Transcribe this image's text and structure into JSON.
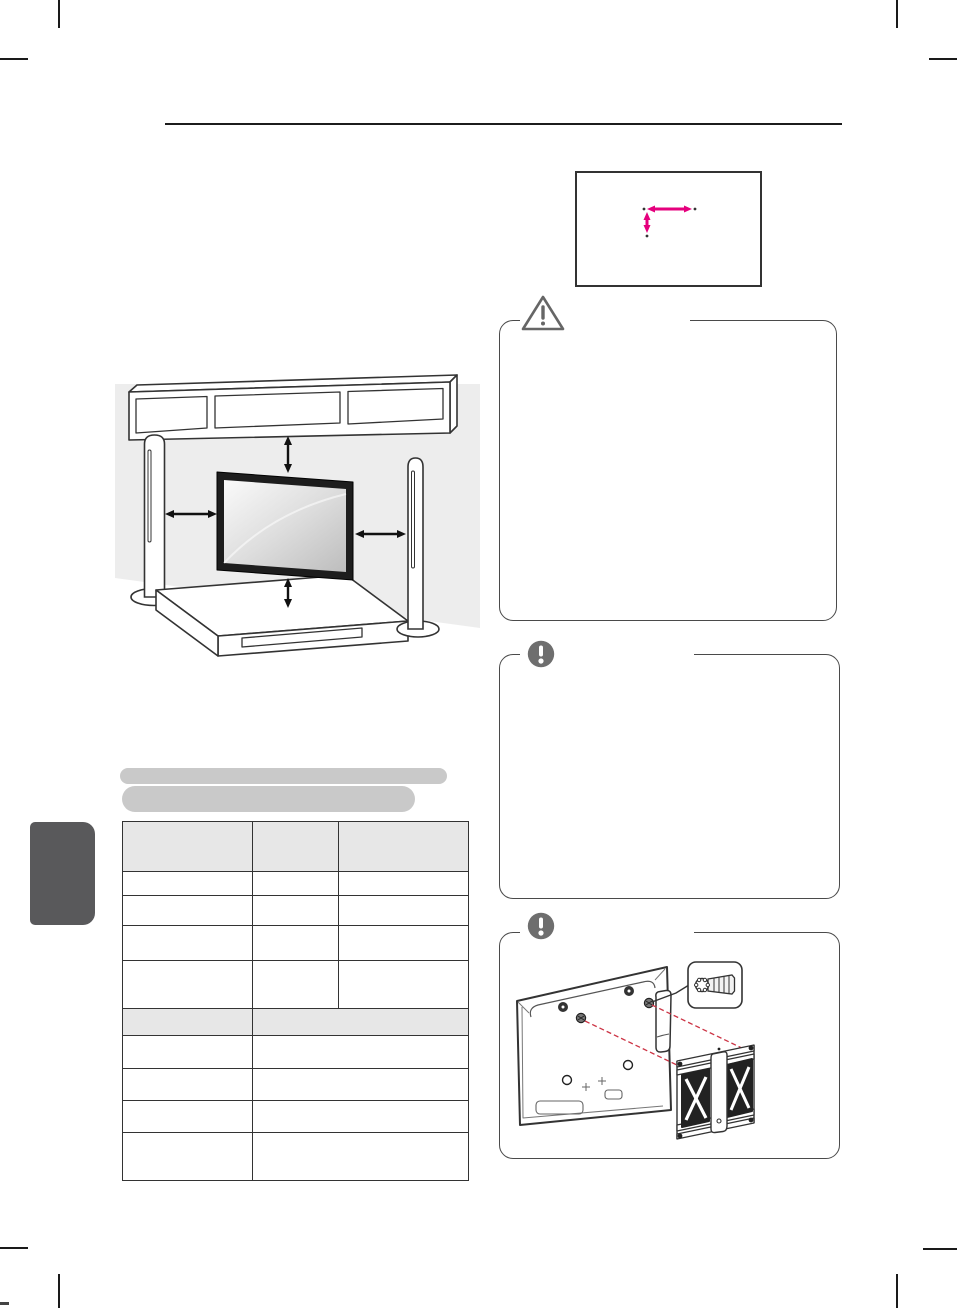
{
  "document": {
    "kind": "printed-manual-page",
    "visible_text_present": false,
    "colors": {
      "background": "#ffffff",
      "accent_magenta": "#e5007d",
      "header_rule": "#1c1c1c",
      "box_border": "#4a4a4a",
      "icon_gray": "#6e6e6e",
      "table_line": "#333333",
      "table_header_bg": "#e7e7e7",
      "heading_highlight": "#c9c9c9",
      "side_tab": "#59595b",
      "wall_shade": "#ededed",
      "dashed_guide_red": "#cc3344",
      "tv_frame": "#1d1d1d"
    }
  },
  "header": {
    "rule_present": true,
    "text": ""
  },
  "vesa_dimension_box": {
    "arrow_color": "#e5007d",
    "arrows": [
      {
        "direction": "horizontal"
      },
      {
        "direction": "vertical"
      }
    ],
    "text": ""
  },
  "caution_box": {
    "icon": "warning-triangle-icon",
    "title": "",
    "text": ""
  },
  "note_boxes": [
    {
      "icon": "exclamation-circle-icon",
      "title": "",
      "text": ""
    },
    {
      "icon": "exclamation-circle-icon",
      "title": "",
      "text": "",
      "illustration": "tv-rear-with-wall-bracket-screws-and-callout"
    }
  ],
  "clearance_illustration": {
    "elements": [
      "wall-shelf",
      "left-tower-speaker",
      "right-tower-speaker",
      "flat-tv",
      "media-cabinet"
    ],
    "clearance_arrows": [
      "top",
      "bottom",
      "left",
      "right"
    ]
  },
  "section_heading_highlights": {
    "count": 2,
    "text": ""
  },
  "spec_table": {
    "section_a": {
      "columns": 3,
      "header_shaded": true,
      "data_rows": 4,
      "col_widths_px": [
        130,
        86,
        130
      ]
    },
    "section_b": {
      "columns": 2,
      "header_shaded": true,
      "data_rows": 4,
      "col_widths_px": [
        130,
        216
      ]
    },
    "cell_text": ""
  },
  "crop_marks": {
    "corners": [
      "top-left",
      "top-right",
      "bottom-left",
      "bottom-right"
    ]
  }
}
